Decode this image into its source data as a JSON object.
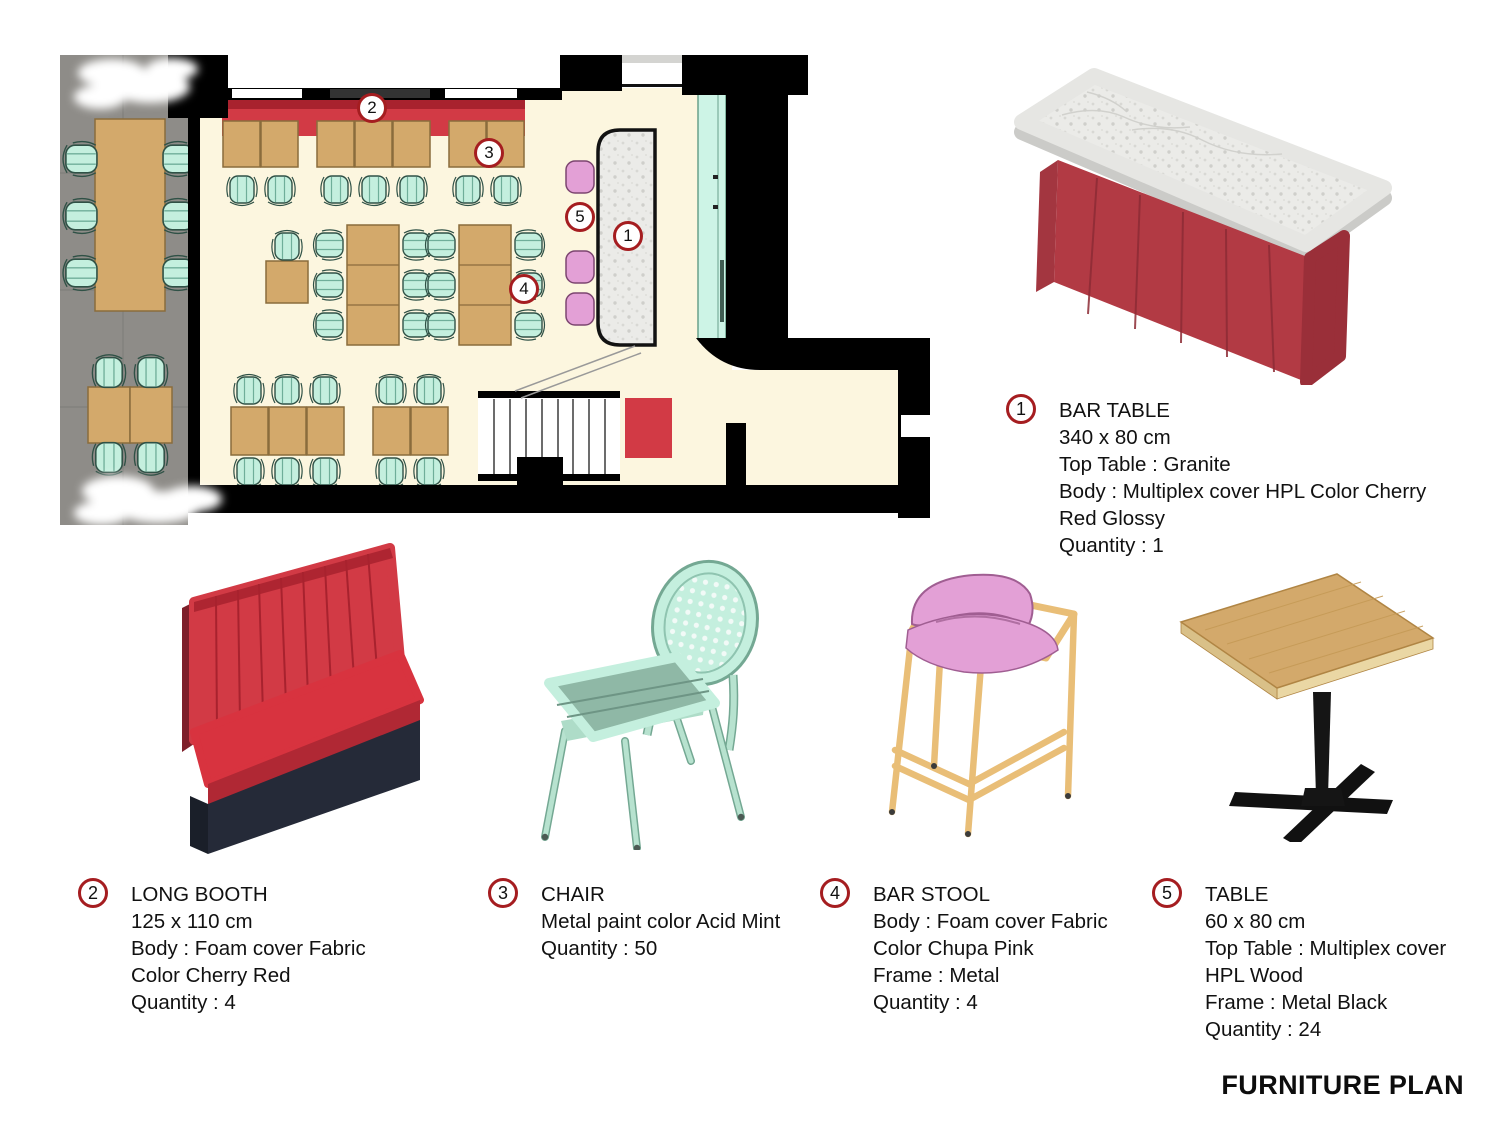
{
  "title": "FURNITURE PLAN",
  "colors": {
    "wall": "#000000",
    "floor": "#fcf6df",
    "outdoor": "#8e8c88",
    "wood": "#d3a96b",
    "mint": "#c4efde",
    "seat-green": "#8fb8a6",
    "red": "#d23a45",
    "red-dark": "#a8222e",
    "pink": "#e3a0d6",
    "marble": "#ebebe8",
    "marker-ring": "#a51d20",
    "navy": "#252a38",
    "tan": "#e9be77",
    "ink": "#111111"
  },
  "plan": {
    "markers": [
      "1",
      "2",
      "3",
      "4",
      "5"
    ]
  },
  "legend": [
    {
      "number": "1",
      "name": "BAR TABLE",
      "lines": [
        "340 x 80 cm",
        "Top Table : Granite",
        "Body : Multiplex cover HPL Color Cherry",
        "Red Glossy",
        "Quantity : 1"
      ]
    },
    {
      "number": "2",
      "name": "LONG BOOTH",
      "lines": [
        "125 x 110 cm",
        "Body : Foam cover Fabric",
        "Color Cherry Red",
        "Quantity : 4"
      ]
    },
    {
      "number": "3",
      "name": "CHAIR",
      "lines": [
        "Metal paint color Acid Mint",
        "Quantity : 50"
      ]
    },
    {
      "number": "4",
      "name": "BAR STOOL",
      "lines": [
        "Body : Foam cover Fabric",
        "Color Chupa Pink",
        "Frame : Metal",
        "Quantity : 4"
      ]
    },
    {
      "number": "5",
      "name": "TABLE",
      "lines": [
        "60 x 80 cm",
        "Top Table : Multiplex cover",
        "HPL Wood",
        "Frame : Metal Black",
        "Quantity : 24"
      ]
    }
  ]
}
